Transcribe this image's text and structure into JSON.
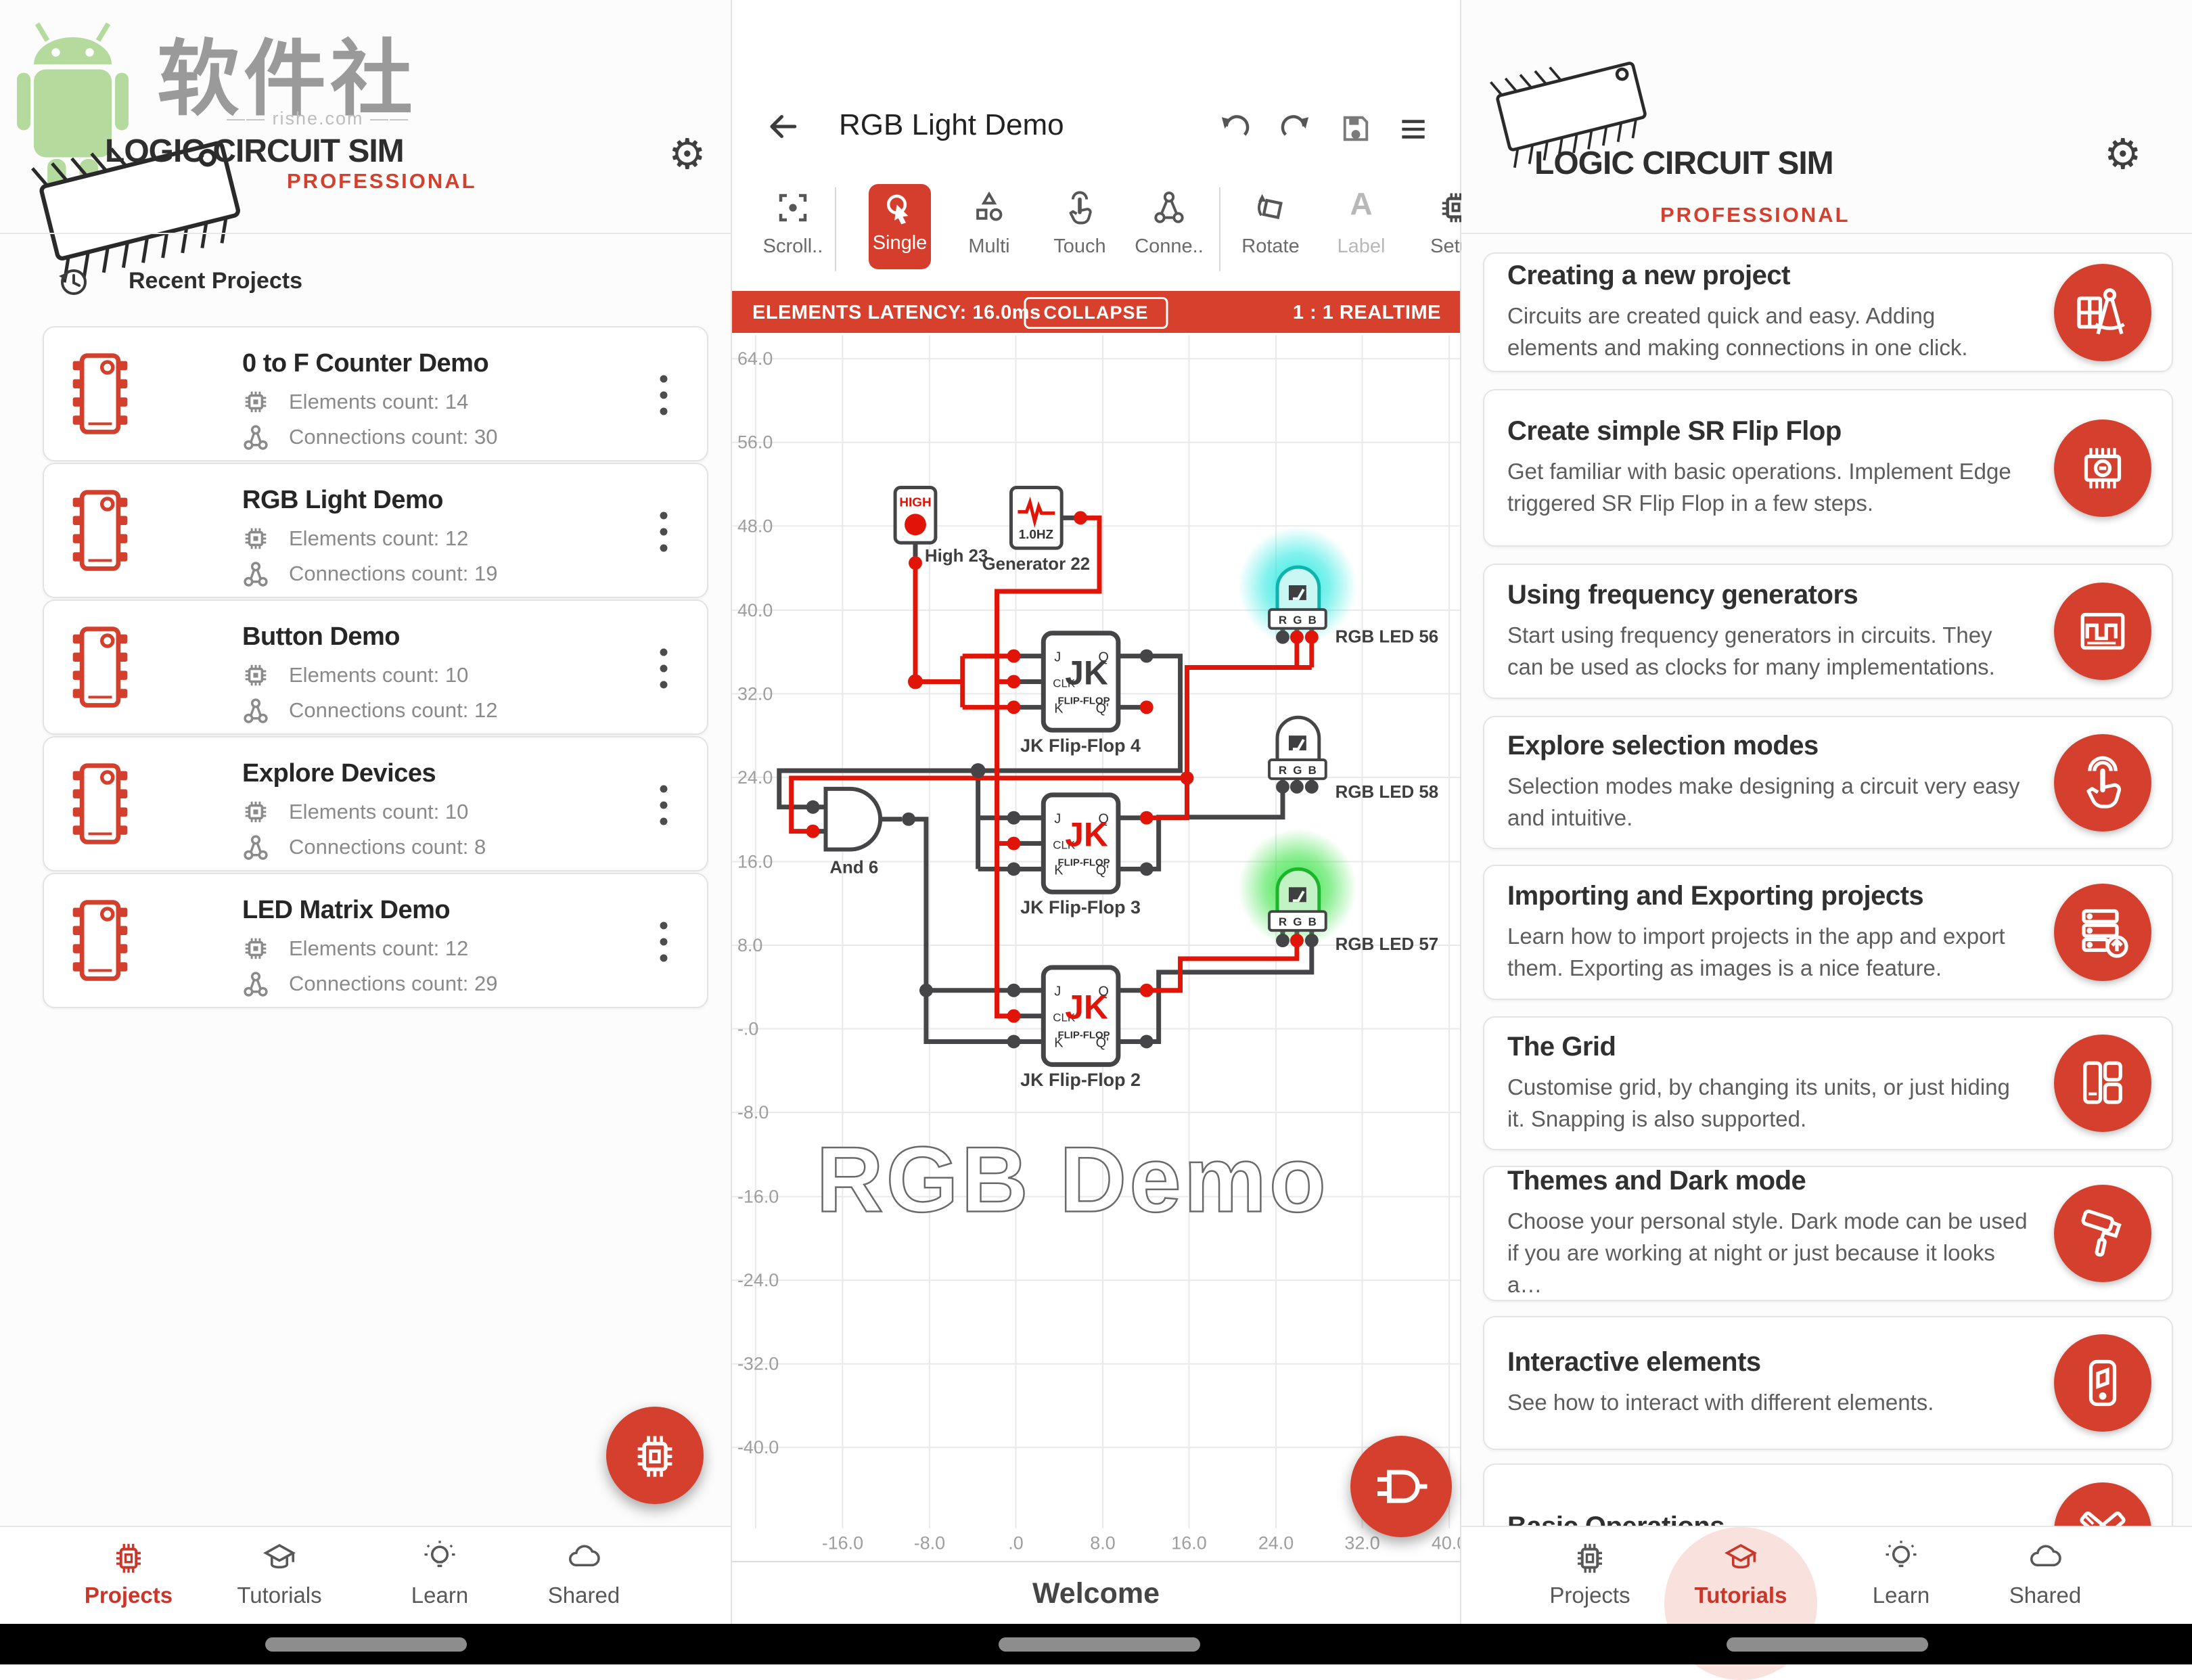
{
  "brand": {
    "title": "LOGIC CIRCUIT SIM",
    "edition": "PROFESSIONAL",
    "cn": "软件社",
    "site": "—— rishe.com ——"
  },
  "left": {
    "section": "Recent Projects",
    "projects": [
      {
        "title": "0 to F Counter Demo",
        "elements": "Elements count: 14",
        "connections": "Connections count: 30"
      },
      {
        "title": "RGB Light Demo",
        "elements": "Elements count: 12",
        "connections": "Connections count: 19"
      },
      {
        "title": "Button Demo",
        "elements": "Elements count: 10",
        "connections": "Connections count: 12"
      },
      {
        "title": "Explore Devices",
        "elements": "Elements count: 10",
        "connections": "Connections count: 8"
      },
      {
        "title": "LED Matrix Demo",
        "elements": "Elements count: 12",
        "connections": "Connections count: 29"
      }
    ],
    "nav": [
      "Projects",
      "Tutorials",
      "Learn",
      "Shared"
    ]
  },
  "editor": {
    "title": "RGB Light Demo",
    "toolbar": [
      "Scroll..",
      "Single",
      "Multi",
      "Touch",
      "Conne..",
      "Rotate",
      "Label",
      "Setu.."
    ],
    "label_icon": "A",
    "banner": {
      "latency": "ELEMENTS LATENCY: 16.0ms",
      "collapse": "COLLAPSE",
      "ratio": "1 : 1 REALTIME"
    },
    "watermark": "RGB Demo",
    "welcome": "Welcome",
    "y_ticks": [
      "64.0",
      "56.0",
      "48.0",
      "40.0",
      "32.0",
      "24.0",
      "16.0",
      "8.0",
      "-.0",
      "-8.0",
      "-16.0",
      "-24.0",
      "-32.0",
      "-40.0"
    ],
    "x_ticks": [
      "-16.0",
      "-8.0",
      ".0",
      "8.0",
      "16.0",
      "24.0",
      "32.0",
      "40.0"
    ],
    "comp": {
      "high_tag": "HIGH",
      "high_label": "High 23",
      "gen_freq": "1.0HZ",
      "gen_label": "Generator 22",
      "and_label": "And 6",
      "ff4": "JK Flip-Flop 4",
      "ff3": "JK Flip-Flop 3",
      "ff2": "JK Flip-Flop 2",
      "jk": "JK",
      "flipflop": "FLIP-FLOP",
      "j": "J",
      "clk": "CLK",
      "k": "K",
      "q": "Q",
      "qn": "Q'",
      "led56": "RGB LED 56",
      "led58": "RGB LED 58",
      "led57": "RGB LED 57",
      "r": "R",
      "g": "G",
      "b": "B"
    }
  },
  "right": {
    "tutorials": [
      {
        "title": "Creating a new project",
        "desc": "Circuits are created quick and easy. Adding elements and making connections in one click."
      },
      {
        "title": "Create simple SR Flip Flop",
        "desc": "Get familiar with basic operations. Implement Edge triggered SR Flip Flop in a few steps."
      },
      {
        "title": "Using frequency generators",
        "desc": "Start using frequency generators in circuits. They can be used as clocks for many implementations."
      },
      {
        "title": "Explore selection modes",
        "desc": "Selection modes make designing a circuit very easy and intuitive."
      },
      {
        "title": "Importing and Exporting projects",
        "desc": "Learn how to import projects in the app and export them. Exporting as images is a nice feature."
      },
      {
        "title": "The Grid",
        "desc": "Customise grid, by changing its units, or just hiding it. Snapping is also supported."
      },
      {
        "title": "Themes and Dark mode",
        "desc": "Choose your personal style. Dark mode can be used if you are working at night or just because it looks a…"
      },
      {
        "title": "Interactive elements",
        "desc": "See how to interact with different elements."
      },
      {
        "title": "Basic Operations",
        "desc": ""
      }
    ],
    "nav": [
      "Projects",
      "Tutorials",
      "Learn",
      "Shared"
    ]
  },
  "colors": {
    "accent": "#d5402e",
    "wire_on": "#e11408",
    "wire_off": "#454548",
    "glow_cyan": "#1ee8e0",
    "glow_green": "#30e23c"
  }
}
